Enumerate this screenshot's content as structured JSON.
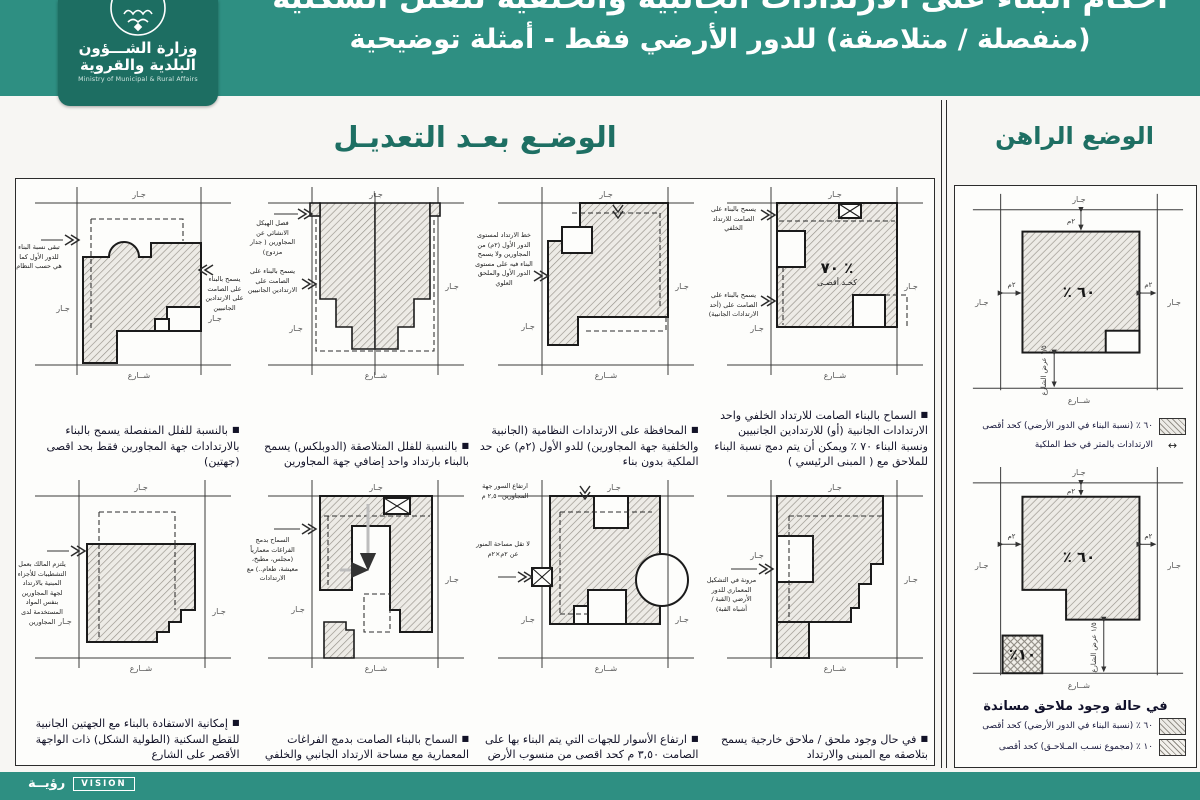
{
  "header": {
    "title_line1": "أحكام البناء على الارتدادات الجانبية والخلفية للفلل السكنية",
    "title_line2": "(منفصلة / متلاصقة) للدور الأرضي فقط - أمثلة توضيحية"
  },
  "logo": {
    "ar1": "وزارة الشـــؤون",
    "ar2": "البلدية والقروية",
    "en": "Ministry of Municipal & Rural Affairs"
  },
  "sections": {
    "after": "الوضـع بعـد التعديـل",
    "current": "الوضع الراهن"
  },
  "common": {
    "neighbor": "جـار",
    "street": "شــارع"
  },
  "bullet": "■",
  "modified": {
    "m1": {
      "pct": "٪ ٧٠",
      "pct_sub": "كحـد أقصـى",
      "a1": "يسمح بالبناء على الصامت للارتداد الخلفي",
      "a2": "يسمح بالبناء على الصامت على (أحد الارتدادات الجانبية)",
      "caption": "السماح بالبناء الصامت للارتداد الخلفي واحد الارتدادات الجانبية (أو) للارتدادين الجانبيين ونسبة البناء ٧٠ ٪ ويمكن أن يتم دمج نسبة البناء للملاحق مع ( المبنى الرئيسي )"
    },
    "m2": {
      "a1": "خط الارتداد لمستوى الدور الأول (٢م) من المجاورين ولا يسمح البناء فيه على مستوى الدور الأول والملحق العلوي",
      "caption": "المحافظة على الارتدادات النظامية (الجانبية والخلفية جهة المجاورين) للدو الأول (٢م) عن حد الملكية بدون بناء"
    },
    "m3": {
      "a1": "فصل الهيكل الانشائي عن المجاورين ( جدار مزدوج)",
      "a2": "يسمح بالبناء على الصامت على الارتدادين الجانبيين",
      "caption": "بالنسبة للفلل المتلاصقة (الدوبلكس) يسمح بالبناء بارتداد واحد إضافي جهة المجاورين"
    },
    "m4": {
      "a1": "تبقى نسبة البناء للدور الأول كما هي حسب النظام",
      "a2": "يسمح بالبناء على الصامت على الارتدادين الجانبيين",
      "caption": "بالنسبة للفلل المنفصلة يسمح بالبناء بالارتدادات جهة المجاورين فقط بحد اقصى (جهتين)"
    },
    "m5": {
      "a1": "مرونة في التشكيل المعماري للدور الأرضي (القبة / أشباه القبة)",
      "caption": "في حال وجود ملحق / ملاحق خارجية يسمح بتلاصقه مع المبنى والارتداد"
    },
    "m6": {
      "a1": "ارتفاع السور جهة المجاورين ٢,٥٠ م",
      "a2": "لا تقل مساحة المنور عن ٢م×٢م",
      "caption": "ارتفاع الأسوار للجهات التي يتم البناء بها على الصامت ٣,٥٠ م كحد اقصى من منسوب الأرض"
    },
    "m7": {
      "a1": "السماح بدمج الفراغات معمارياً (مجلس، مطبخ، معيشة، طعام..) مع الارتدادات",
      "caption": "السماح بالبناء الصامت بدمج الفراغات المعمارية مع مساحة الارتداد الجانبي والخلفي"
    },
    "m8": {
      "a1": "يلتزم المالك بعمل التشطيبات للأجزاء المبنية بالارتداد لجهة المجاورين بنفس المواد المستخدمة لدى المجاورين",
      "caption": "إمكانية الاستفادة بالبناء مع الجهتين الجانبية للقطع السكنية (الطولية الشكل) ذات الواجهة الأقصر على الشارع"
    }
  },
  "current": {
    "c1": {
      "pct": "٪ ٦٠",
      "dim": "٢م",
      "street_dim": "١/٥ عرض الشارع",
      "legend_pct": "٦٠ ٪ (نسبة البناء في الدور الأرضي) كحد أقصى",
      "legend_setback": "الارتدادات بالمتر في خط الملكية"
    },
    "c2": {
      "pct": "٪ ٦٠",
      "annex_pct": "٪١٠",
      "dim": "٢م",
      "street_dim": "١/٥ عرض الشارع",
      "title": "في حالة وجود ملاحق مساندة",
      "legend_pct": "٦٠ ٪ (نسبة البناء في الدور الأرضي) كحد أقصى",
      "legend_annex": "١٠ ٪ (مجموع نسـب المـلاحـق) كحد أقصى"
    }
  },
  "footer": {
    "vision_ar": "رؤيــة",
    "vision_en": "VISION"
  }
}
